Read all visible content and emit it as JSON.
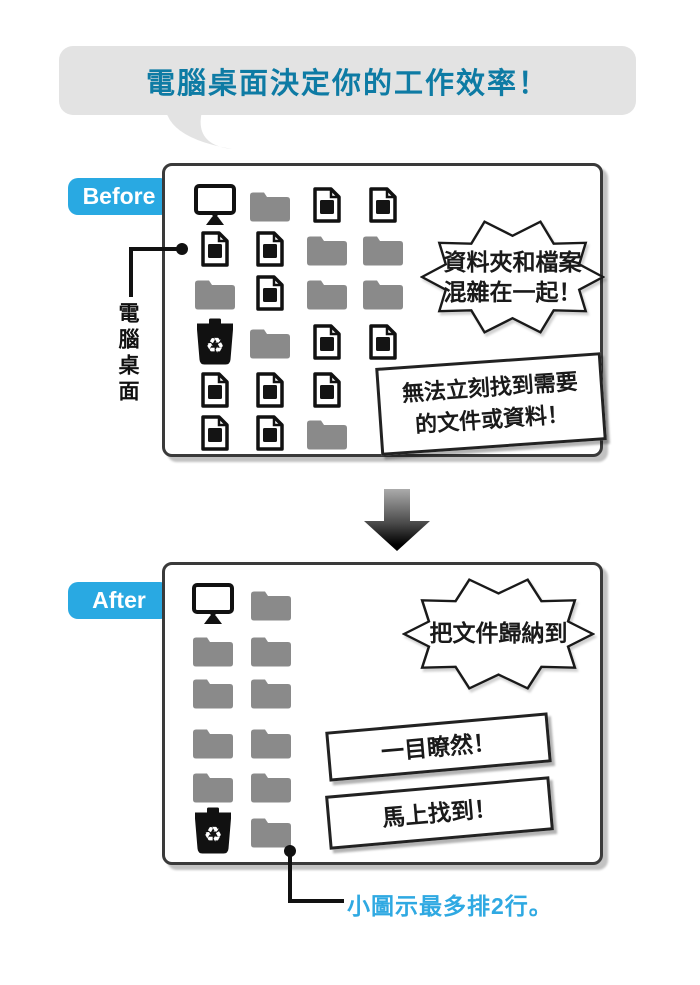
{
  "banner": {
    "title": "電腦桌面決定你的工作效率！"
  },
  "before": {
    "label": "Before",
    "side_caption": "電腦桌面",
    "grid": [
      [
        "monitor",
        "folder",
        "document",
        "document"
      ],
      [
        "document",
        "document",
        "folder",
        "folder"
      ],
      [
        "folder",
        "document",
        "folder",
        "folder"
      ],
      [
        "recycle-bin",
        "folder",
        "document",
        "document"
      ],
      [
        "document",
        "document",
        "document",
        ""
      ],
      [
        "document",
        "document",
        "folder",
        ""
      ]
    ],
    "burst_line1": "資料夾和檔案",
    "burst_line2": "混雜在一起！",
    "note_line1": "無法立刻找到需要",
    "note_line2": "的文件或資料！"
  },
  "after": {
    "label": "After",
    "grid": [
      [
        "monitor",
        "folder"
      ],
      [
        "folder",
        "folder"
      ],
      [
        "folder",
        "folder"
      ],
      [
        "folder",
        "folder"
      ],
      [
        "folder",
        "folder"
      ],
      [
        "recycle-bin",
        "folder"
      ]
    ],
    "burst_line1": "把文件歸納到",
    "burst_line2": "資料夾裡！",
    "sign1": "一目瞭然！",
    "sign2": "馬上找到！",
    "footnote": "小圖示最多排2行。"
  },
  "colors": {
    "accent_blue": "#29A9E2",
    "title_teal": "#0E7BA4",
    "footnote_blue": "#2FA9E2",
    "folder_gray": "#8A8A8A",
    "banner_gray": "#E3E3E3"
  }
}
